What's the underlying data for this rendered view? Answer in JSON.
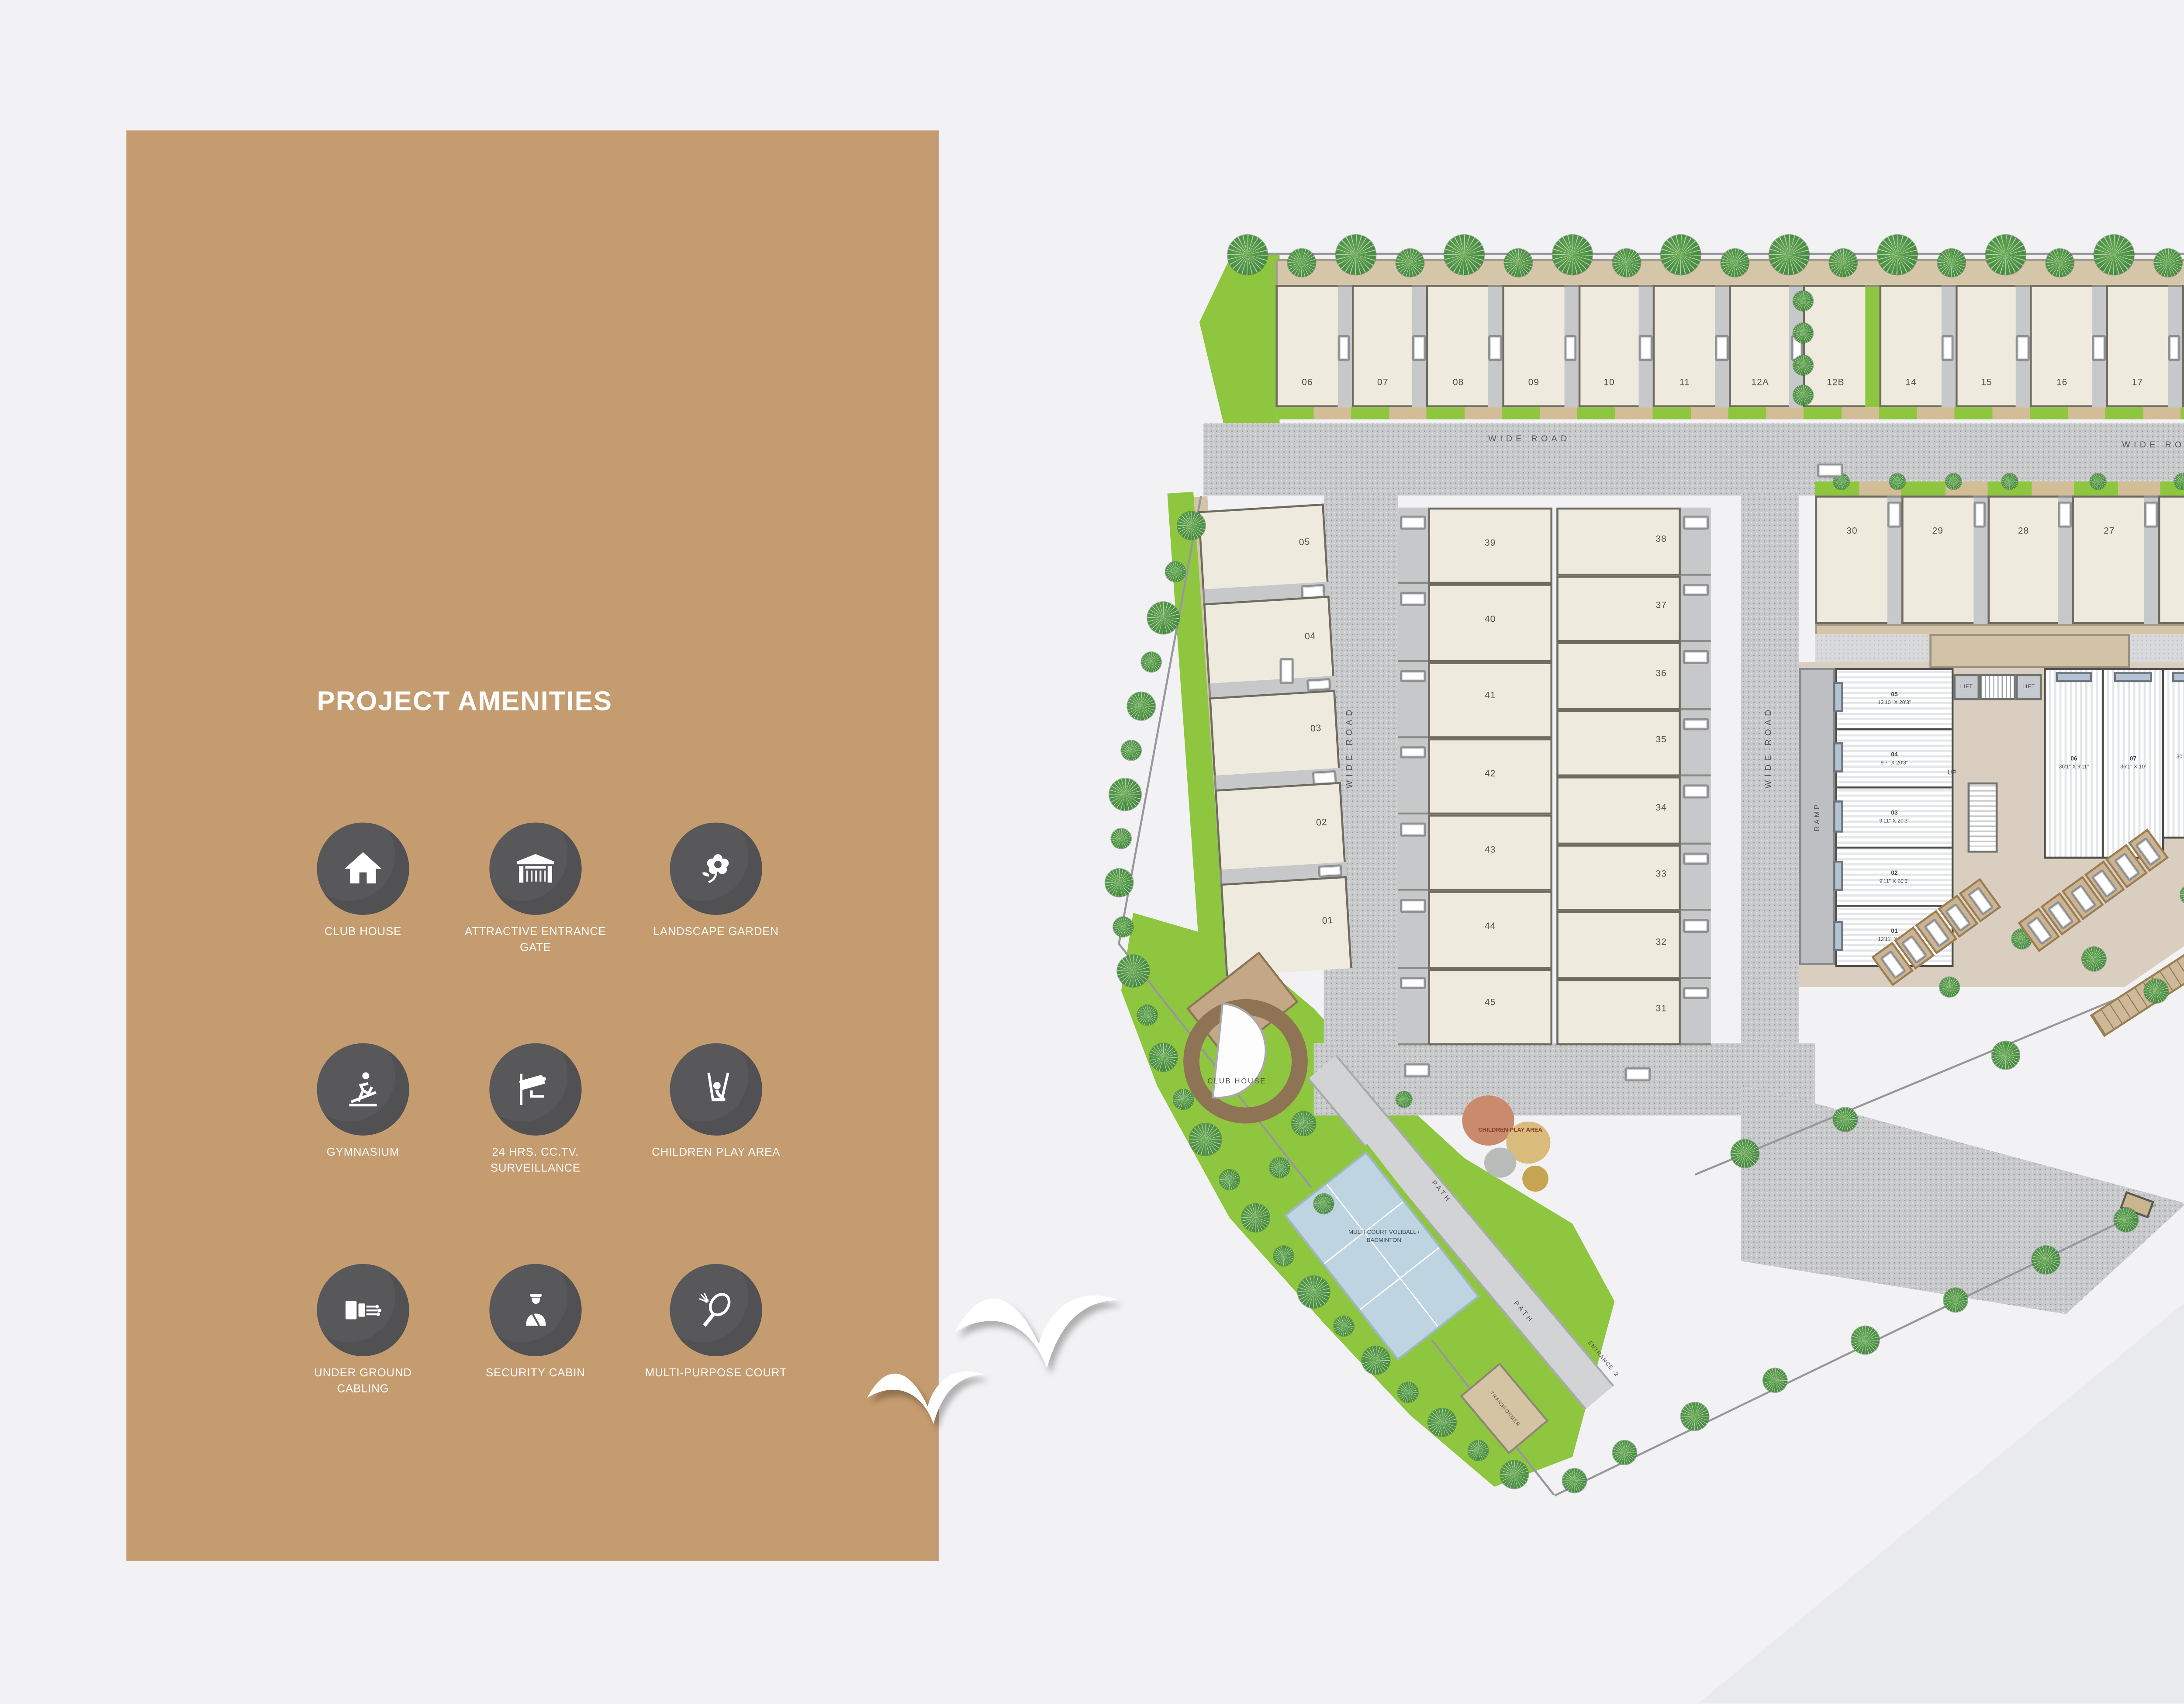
{
  "sidebar": {
    "title": "PROJECT AMENITIES",
    "amenities": [
      {
        "icon": "house-icon",
        "label": "CLUB HOUSE"
      },
      {
        "icon": "gate-icon",
        "label": "ATTRACTIVE ENTRANCE GATE"
      },
      {
        "icon": "flower-icon",
        "label": "LANDSCAPE GARDEN"
      },
      {
        "icon": "treadmill-icon",
        "label": "GYMNASIUM"
      },
      {
        "icon": "cctv-camera-icon",
        "label": "24 HRS. CC.TV. SURVEILLANCE"
      },
      {
        "icon": "swing-icon",
        "label": "CHILDREN PLAY AREA"
      },
      {
        "icon": "cable-icon",
        "label": "UNDER GROUND CABLING"
      },
      {
        "icon": "security-guard-icon",
        "label": "SECURITY CABIN"
      },
      {
        "icon": "racket-icon",
        "label": "MULTI-PURPOSE COURT"
      }
    ]
  },
  "plan": {
    "road_label": "WIDE ROAD",
    "top_row": [
      "06",
      "07",
      "08",
      "09",
      "10",
      "11",
      "12A",
      "12B",
      "14",
      "15",
      "16",
      "17",
      "18",
      "19",
      "20",
      "21"
    ],
    "unit_22": "22",
    "row2": [
      "30",
      "29",
      "28",
      "27",
      "26",
      "25",
      "24",
      "23"
    ],
    "left_col": [
      "05",
      "04",
      "03",
      "02",
      "01"
    ],
    "mid_left_col": [
      "39",
      "40",
      "41",
      "42",
      "43",
      "44",
      "45"
    ],
    "mid_right_col": [
      "38",
      "37",
      "36",
      "35",
      "34",
      "33",
      "32",
      "31"
    ],
    "shops_left": [
      {
        "no": "05",
        "dim": "13'10\" X 20'3\""
      },
      {
        "no": "04",
        "dim": "9'7\" X 20'3\""
      },
      {
        "no": "03",
        "dim": "9'11\" X 20'3\""
      },
      {
        "no": "02",
        "dim": "9'11\" X 20'3\""
      },
      {
        "no": "01",
        "dim": "12'11\" X 20'3\""
      }
    ],
    "shops_top": [
      {
        "no": "06",
        "dim": "36'1\" X 9'11\""
      },
      {
        "no": "07",
        "dim": "36'1\" X 10'"
      },
      {
        "no": "08",
        "dim": "30'5\" X 10'"
      },
      {
        "no": "09",
        "dim": "30'5\" X 10'4\""
      },
      {
        "no": "10",
        "dim": "27'7\" X 10'2\""
      },
      {
        "no": "11",
        "dim": "24'9\" X 10'"
      },
      {
        "no": "12A",
        "dim": "22'4\" X 10'4\""
      },
      {
        "no": "12B",
        "dim": "19' X 9'9\""
      }
    ],
    "labels": {
      "lift": "LIFT",
      "up": "UP",
      "ramp": "RAMP",
      "club_house": "CLUB HOUSE",
      "children_play_area": "CHILDREN PLAY AREA",
      "multi_court": "MULTI COURT VOLIBALL / BADMINTON",
      "path": "PATH",
      "transformer": "TRANSFORMER",
      "entrance_2": "ENTRANCE -2"
    }
  },
  "footer": {
    "title": "LAYOUT PLAN",
    "compass": {
      "top": "E",
      "left": "N",
      "right": "S",
      "bottom": "W"
    }
  },
  "colors": {
    "sidebar_brown": "#c59c6f",
    "amenity_circle": "#58585b",
    "lawn_green": "#8ec63f",
    "tree_green": "#4d9145",
    "house_cream": "#efeade",
    "court_blue": "#bfd4e1",
    "compass_red": "#e63329"
  }
}
